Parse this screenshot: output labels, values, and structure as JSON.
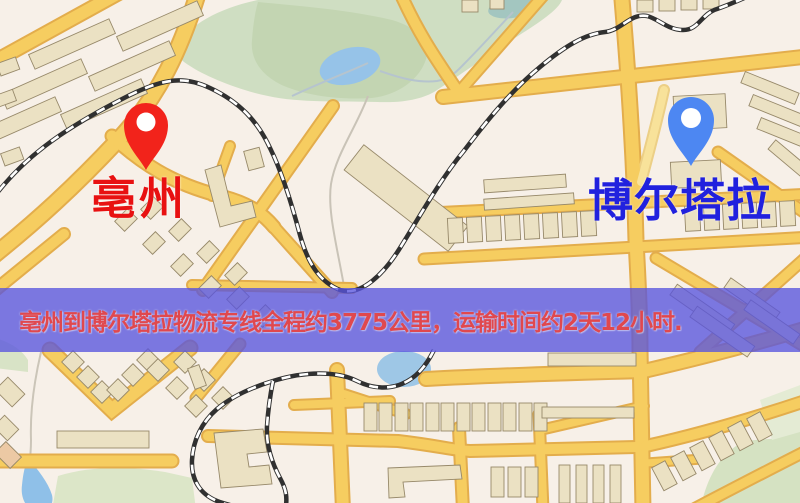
{
  "markers": {
    "origin": {
      "label": "亳州",
      "pin_color": "#f2231b",
      "label_color": "#e81111"
    },
    "destination": {
      "label": "博尔塔拉",
      "pin_color": "#4d87f2",
      "label_color": "#2121de"
    }
  },
  "banner": {
    "text": "亳州到博尔塔拉物流专线全程约3775公里，运输时间约2天12小时.",
    "background_color": "#5855de",
    "text_color": "#e0484e",
    "distance": "约3775公里",
    "duration": "约2天12小时"
  },
  "map_palette": {
    "background": "#f7f0e8",
    "road_fill": "#f6cd60",
    "road_casing": "#e3ad4c",
    "building": "#ebe1c3",
    "park_green": "#cfdec2",
    "water_blue": "#96c3e8",
    "railway": "#303030"
  }
}
